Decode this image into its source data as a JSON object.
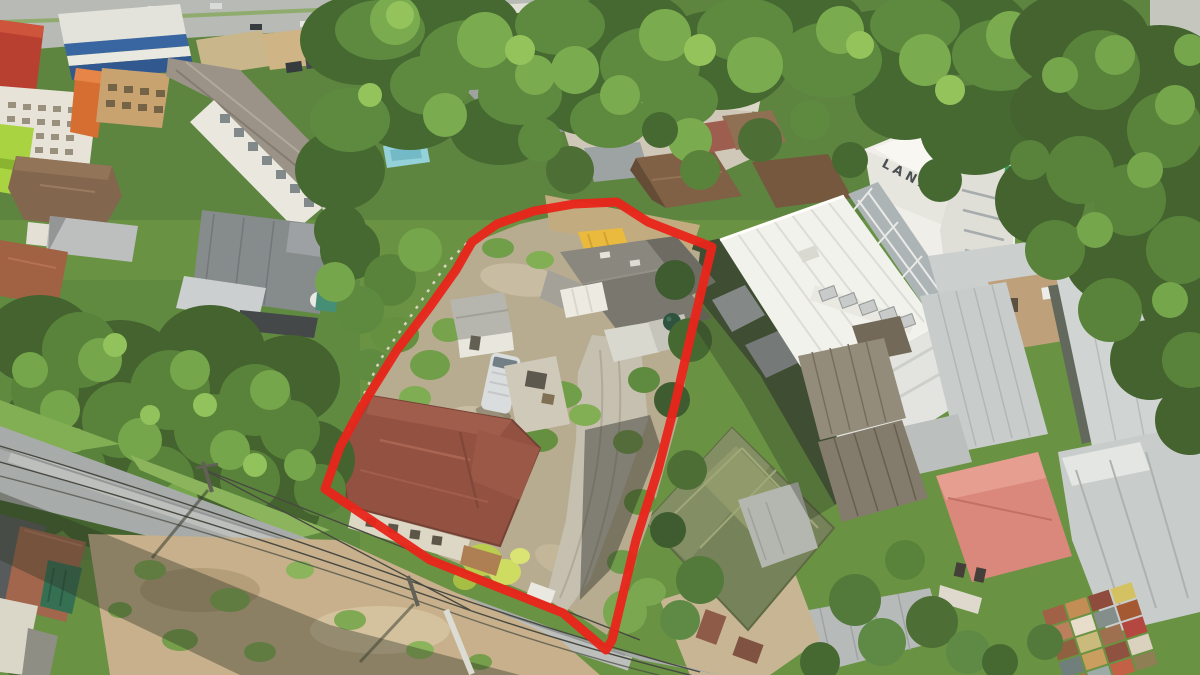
{
  "meta": {
    "description": "Aerial drone photograph of a land plot outlined in red among houses, trees and a white hotel building",
    "image_type": "aerial-photograph"
  },
  "annotation": {
    "boundary_color": "#E8251B",
    "boundary_stroke_width": "9",
    "boundary_points": "617,202 648,222 712,247 692,330 676,400 658,470 636,540 612,640 606,650 563,613 430,560 325,489 340,447 362,406 397,350 429,308 456,270 472,242 497,224 534,211 574,204"
  },
  "labels": {
    "hotel_sign": "LANA"
  },
  "palette": {
    "vegetation": "#618E3E",
    "vegetation_dark": "#3D612B",
    "road_gray": "#A3A8A9",
    "dirt_tan": "#C4AD8A",
    "gravel": "#C3BEB2",
    "maroon_roof": "#8E4A3C",
    "green_roof": "#6F7D55",
    "hotel_white": "#F2F3F1",
    "silver_roof": "#C6CCCE",
    "salmon_roof": "#D9837A",
    "yellow_tarp": "#E8B838",
    "pool_blue": "#8FD0DC",
    "sign_green": "#2F9E5A"
  }
}
